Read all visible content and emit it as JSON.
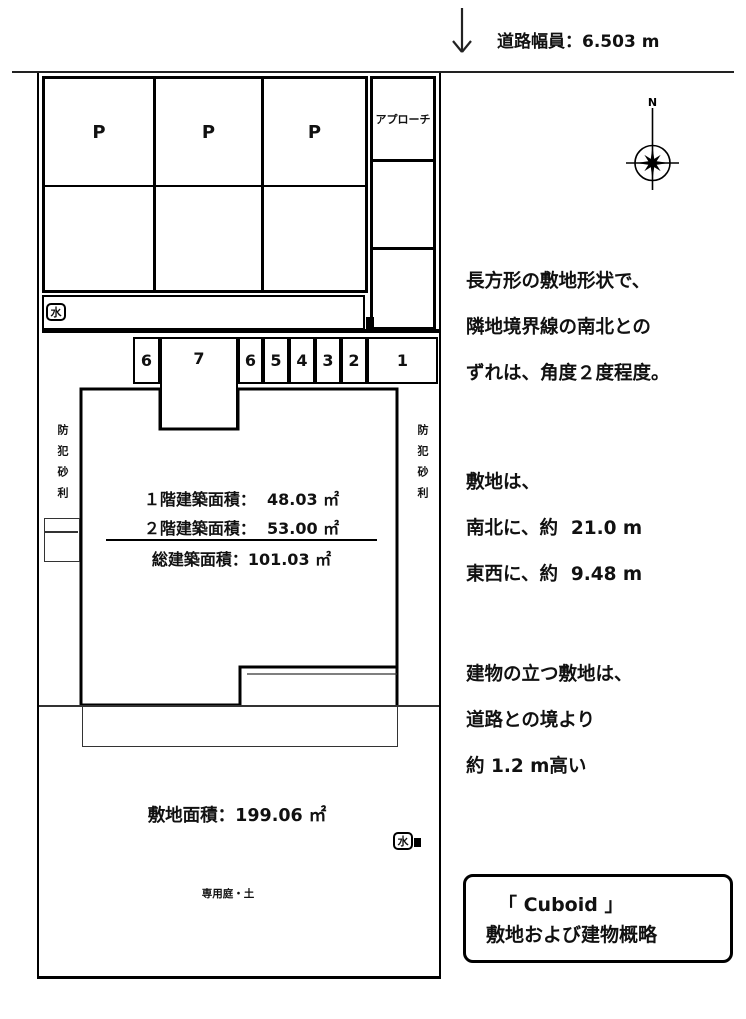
{
  "colors": {
    "line": "#000000",
    "text": "#111111",
    "background": "#ffffff"
  },
  "road": {
    "width_label": "道路幅員：6.503 m"
  },
  "compass": {
    "north_label": "N"
  },
  "plan": {
    "parking_stall_labels": [
      "P",
      "P",
      "P"
    ],
    "approach_label": "アプローチ",
    "water_meter_top": "水",
    "water_meter_bottom": "水",
    "room_numbers": [
      "6",
      "7",
      "6",
      "5",
      "4",
      "3",
      "2",
      "1"
    ],
    "gravel_left": "防犯砂利",
    "gravel_right": "防犯砂利",
    "building": {
      "floor1_area": "１階建築面積：  48.03 ㎡",
      "floor2_area": "２階建築面積：  53.00 ㎡",
      "total_area": "総建築面積：101.03 ㎡"
    },
    "site_area": "敷地面積：199.06 ㎡",
    "garden_label": "専用庭・土"
  },
  "notes": {
    "shape": [
      "長方形の敷地形状で、",
      "隣地境界線の南北との",
      "ずれは、角度２度程度。"
    ],
    "size": [
      "敷地は、",
      "南北に、約  21.0 m",
      "東西に、約  9.48 m"
    ],
    "elevation": [
      "建物の立つ敷地は、",
      "道路との境より",
      "約 1.2 m高い"
    ]
  },
  "title_box": {
    "line1": "「 Cuboid 」",
    "line2": "敷地および建物概略"
  }
}
